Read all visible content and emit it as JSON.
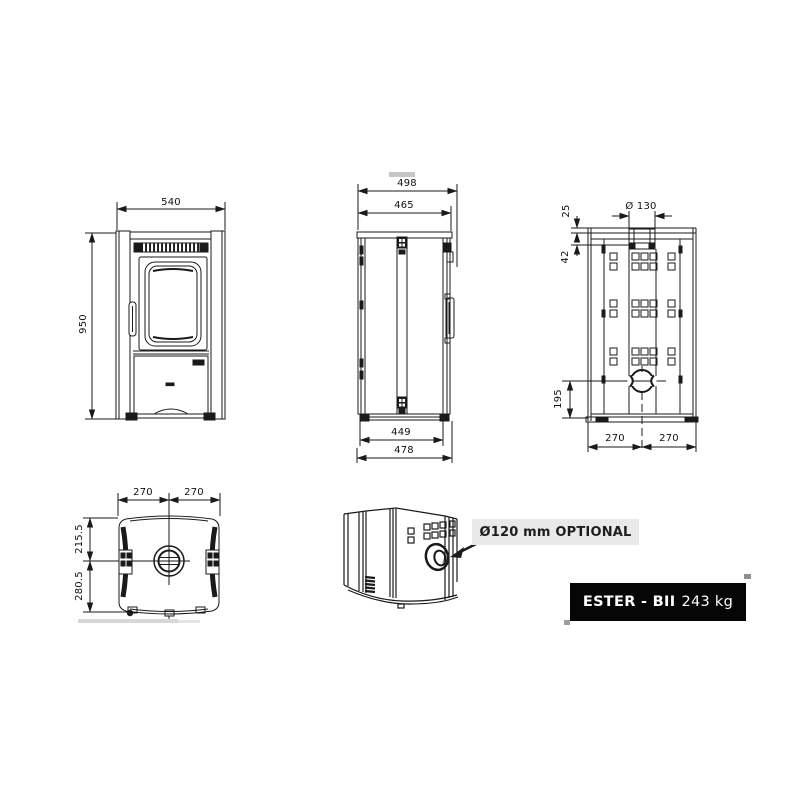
{
  "document": {
    "type_label": "technical dimensional drawing of a wood stove",
    "callout": {
      "text": "Ø120 mm OPTIONAL"
    },
    "plate": {
      "model": "ESTER - BII",
      "weight": "243 kg"
    },
    "colors": {
      "line": "#1a1a1a",
      "callout_bg": "#e9e9e9",
      "plate_bg": "#060606",
      "plate_text": "#ffffff"
    }
  },
  "views": {
    "front": {
      "width": "540",
      "height": "950"
    },
    "side": {
      "depth_overall_top": "498",
      "depth_top": "465",
      "depth_bottom": "449",
      "depth_overall_bottom": "478"
    },
    "rear": {
      "flue_diameter": "Ø 130",
      "flue_offset_a": "25",
      "flue_offset_b": "42",
      "air_inlet_height": "195",
      "half_width_left": "270",
      "half_width_right": "270"
    },
    "top": {
      "half_width_left": "270",
      "half_width_right": "270",
      "flue_center_front": "215.5",
      "flue_center_rear": "280.5"
    }
  }
}
